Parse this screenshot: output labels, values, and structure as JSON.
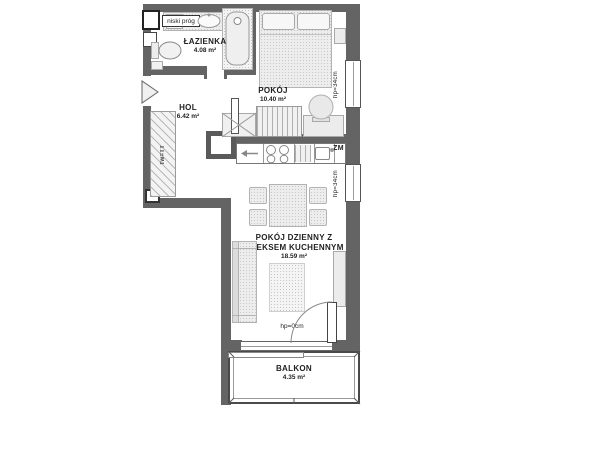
{
  "plan": {
    "rooms": {
      "bathroom": {
        "name": "ŁAZIENKA",
        "area": "4.08 m²"
      },
      "hall": {
        "name": "HOL",
        "area": "6.42 m²"
      },
      "bedroom": {
        "name": "POKÓJ",
        "area": "10.40 m²"
      },
      "living": {
        "name_line1": "POKÓJ DZIENNY Z",
        "name_line2": "ANEKSEM KUCHENNYM",
        "area": "18.59 m²"
      },
      "balcony": {
        "name": "BALKON",
        "area": "4.35 m²"
      }
    },
    "annotations": {
      "low_threshold": "niski próg",
      "dishwasher": "ZM",
      "bedroom_window_sill": "hp=34cm",
      "living_window_sill": "hp=34cm",
      "balcony_door_sill": "hp=0cm",
      "hall_wardrobe": "Tw=TT"
    },
    "icons": {
      "kitchen_arrow": "arrow-left-icon",
      "entrance_marker": "entrance-triangle-icon"
    },
    "colors": {
      "wall": "#646464",
      "outline": "#555555",
      "furniture": "#ededed",
      "text": "#1f1f1f",
      "background": "#ffffff"
    }
  }
}
